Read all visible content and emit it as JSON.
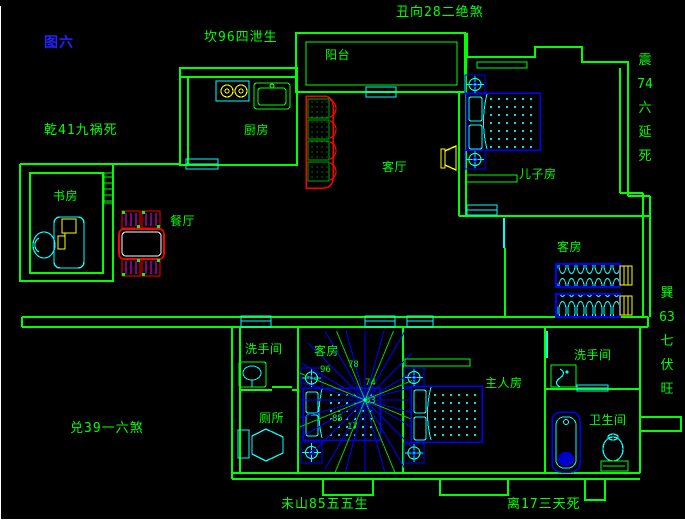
{
  "figure": {
    "label": "图六"
  },
  "annotations": {
    "top_center": "丑向28二绝煞",
    "upper_left": "坎96四泄生",
    "left": "乾41九祸死",
    "lower_left": "兑39一六煞",
    "bottom_left": "未山85五五生",
    "bottom_right": "离17三天死",
    "right_upper": [
      "震",
      "74",
      "六",
      "延",
      "死"
    ],
    "right_lower": [
      "巽",
      "63",
      "七",
      "伏",
      "旺"
    ]
  },
  "rooms": {
    "balcony": "阳台",
    "kitchen": "厨房",
    "living_room": "客厅",
    "sons_room": "儿子房",
    "study": "书房",
    "dining_room": "餐厅",
    "guest_room": "客房",
    "stair_room": "客房",
    "washroom_left": "洗手间",
    "toilet": "厕所",
    "master_bedroom": "主人房",
    "washroom_right": "洗手间",
    "bathroom": "卫生间"
  },
  "compass": {
    "numbers": [
      "96",
      "78",
      "74",
      "63",
      "85",
      "17"
    ]
  },
  "colors": {
    "background": "#000000",
    "wall": "#00FF00",
    "window": "#00FFFF",
    "furniture": "#0000FF",
    "highlight": "#FFFF00",
    "sofa": "#FF0000",
    "chair_accent": "#FF00FF",
    "label_text": "#00FF00",
    "figure_label": "#2222FF"
  }
}
